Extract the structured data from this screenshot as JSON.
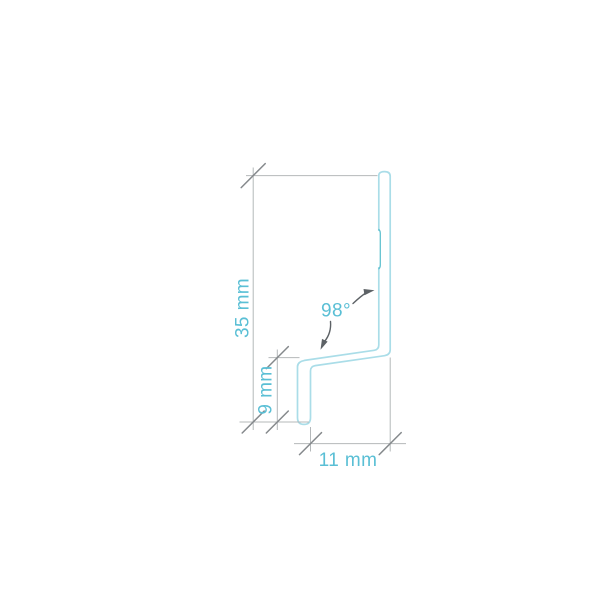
{
  "diagram": {
    "type": "profile-cross-section-drawing",
    "labels": {
      "overall_height": "35 mm",
      "leg_height": "9 mm",
      "base_width": "11 mm",
      "bend_angle": "98°"
    },
    "colors": {
      "profile_stroke": "#aadde8",
      "profile_detail": "#62c2d0",
      "dimension_line": "#b4b8ba",
      "tick_mark": "#85898c",
      "arrow": "#5d6266",
      "label_text": "#5abfd5",
      "background": "#ffffff"
    }
  }
}
